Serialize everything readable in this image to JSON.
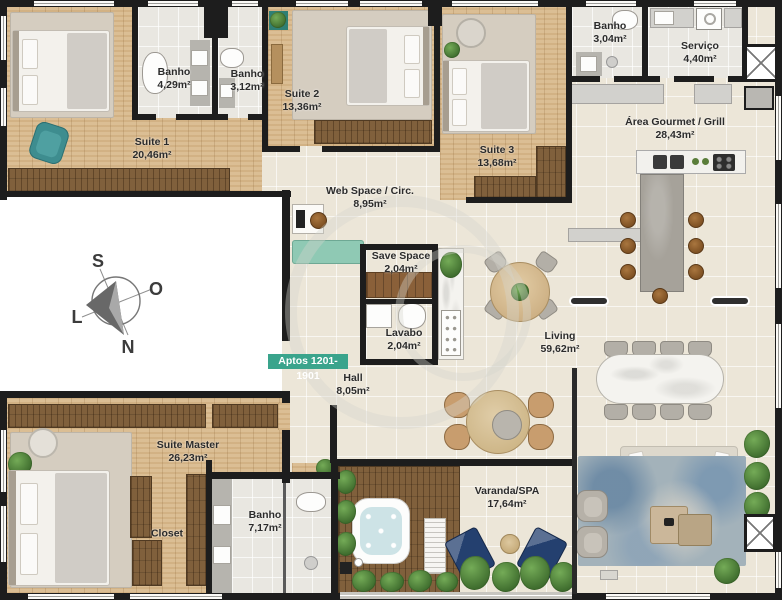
{
  "badge": {
    "label": "Aptos 1201-1901"
  },
  "compass": {
    "n": "N",
    "s": "S",
    "o": "O",
    "l": "L"
  },
  "rooms": {
    "suite1": {
      "name": "Suite 1",
      "area": "20,46m²"
    },
    "banho1": {
      "name": "Banho",
      "area": "4,29m²"
    },
    "banho2": {
      "name": "Banho",
      "area": "3,12m²"
    },
    "suite2": {
      "name": "Suite 2",
      "area": "13,36m²"
    },
    "suite3": {
      "name": "Suite 3",
      "area": "13,68m²"
    },
    "banho3": {
      "name": "Banho",
      "area": "3,04m²"
    },
    "servico": {
      "name": "Serviço",
      "area": "4,40m²"
    },
    "gourmet": {
      "name": "Área Gourmet / Grill",
      "area": "28,43m²"
    },
    "webspace": {
      "name": "Web Space / Circ.",
      "area": "8,95m²"
    },
    "savespace": {
      "name": "Save Space",
      "area": "2,04m²"
    },
    "lavabo": {
      "name": "Lavabo",
      "area": "2,04m²"
    },
    "living": {
      "name": "Living",
      "area": "59,62m²"
    },
    "hall": {
      "name": "Hall",
      "area": "8,05m²"
    },
    "suite_master": {
      "name": "Suite Master",
      "area": "26,23m²"
    },
    "closet": {
      "name": "Closet",
      "area": ""
    },
    "banho_master": {
      "name": "Banho",
      "area": "7,17m²"
    },
    "varanda": {
      "name": "Varanda/SPA",
      "area": "17,64m²"
    }
  },
  "colors": {
    "badge_bg": "#3aa48c",
    "wall": "#1d1d1d",
    "wood_floor": "#d9ba8e",
    "deck_wood": "#80603c",
    "accent_teal": "#3e8d8f",
    "spa_blue": "#24406f"
  }
}
